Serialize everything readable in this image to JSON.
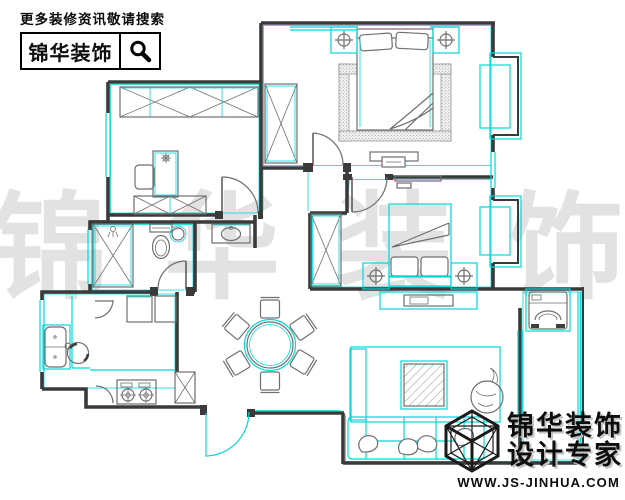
{
  "header": {
    "promo_text": "更多装修资讯敬请搜索",
    "brand_name": "锦华装饰",
    "search_icon": "magnifier-icon"
  },
  "watermark": {
    "chars": [
      "锦",
      "华",
      "装",
      "饰"
    ]
  },
  "logo": {
    "brand_line1": "锦华装饰",
    "brand_line2": "设计专家",
    "website": "WWW.JS-JINHUA.COM",
    "icon": "cube-frame-logo"
  },
  "colors": {
    "wall": "#3a3a3a",
    "line": "#6f6f6f",
    "accent": "#00d9d9",
    "watermark": "#e2e2e2",
    "ink": "#0d0d0d"
  },
  "floorplan": {
    "type": "apartment-floor-plan",
    "rooms": [
      {
        "name": "study",
        "furniture": [
          "wardrobe-x-boxes",
          "desk",
          "chair",
          "desk-lamp",
          "low-bookcase",
          "window-west",
          "door-arc"
        ]
      },
      {
        "name": "master-bedroom",
        "furniture": [
          "double-bed",
          "pillows",
          "stippled-rug-border",
          "nightstand-lamp-left",
          "nightstand-lamp-right",
          "wardrobe",
          "tv-cabinet",
          "bay-window-east",
          "door-arc"
        ]
      },
      {
        "name": "bathroom",
        "furniture": [
          "shower-cabin",
          "toilet",
          "small-basin",
          "door-arc",
          "window-west"
        ]
      },
      {
        "name": "hallway",
        "furniture": [
          "vanity-washbasin"
        ]
      },
      {
        "name": "second-bedroom",
        "furniture": [
          "bed",
          "pillows",
          "wardrobe",
          "nightstand-lamp-left",
          "nightstand-lamp-right",
          "bay-window-east",
          "wall-shelf",
          "door-arc"
        ]
      },
      {
        "name": "kitchen",
        "furniture": [
          "double-sink",
          "round-bowl",
          "gas-stove-2-burner",
          "counter",
          "flue-duct",
          "wall-cabinets",
          "corner-shelf",
          "window-west"
        ]
      },
      {
        "name": "dining-room",
        "furniture": [
          "round-table",
          "six-chairs"
        ]
      },
      {
        "name": "living-room",
        "furniture": [
          "sofa",
          "sofa-pillows",
          "chaise-bench",
          "coffee-table-hatched",
          "plant-pot",
          "tv-cabinet",
          "rug"
        ]
      },
      {
        "name": "balcony",
        "furniture": [
          "washing-machine",
          "glazed-window-east"
        ]
      },
      {
        "name": "entry",
        "furniture": [
          "entry-door-arc"
        ]
      }
    ]
  }
}
